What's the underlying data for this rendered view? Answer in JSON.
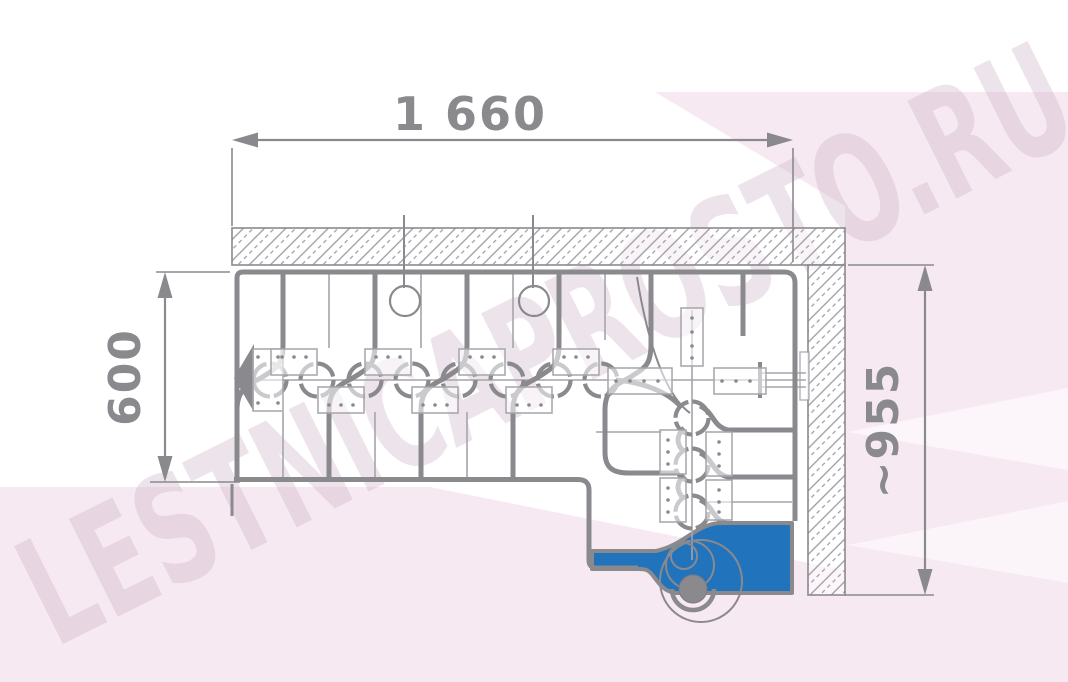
{
  "drawing": {
    "title": "L-shaped modular staircase plan view",
    "dimensions": {
      "top": "1 660",
      "left": "600",
      "right": "~955"
    },
    "watermark": "LESTNICAPROSTO.RU",
    "colors": {
      "line_gray": "#8a8a8e",
      "thin_line_gray": "#a5a4aa",
      "hatch_gray": "#9b9aa1",
      "platform_blue": "#2173bc",
      "background_pink": "#f7e9f2",
      "watermark_pink": "#cbb3c6"
    }
  }
}
